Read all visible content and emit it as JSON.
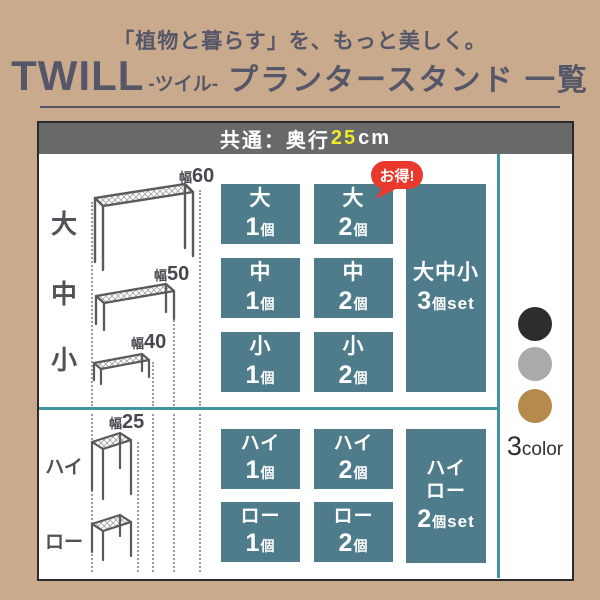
{
  "top_header": {
    "subtitle": "「植物と暮らす」を、もっと美しく。",
    "brand": "TWILL",
    "reading": "-ツイル-",
    "title": "プランタースタンド 一覧"
  },
  "panel_header": {
    "prefix": "共通：奥行",
    "depth_value": "25",
    "unit": "cm"
  },
  "badge": {
    "label": "お得!",
    "color": "#e9392d"
  },
  "row_labels": {
    "large": "大",
    "medium": "中",
    "small": "小",
    "high": "ハイ",
    "low": "ロー"
  },
  "width_labels": {
    "w60": {
      "prefix": "幅",
      "value": "60"
    },
    "w50": {
      "prefix": "幅",
      "value": "50"
    },
    "w40": {
      "prefix": "幅",
      "value": "40"
    },
    "w25": {
      "prefix": "幅",
      "value": "25"
    }
  },
  "products": {
    "large_1": {
      "name": "大",
      "qty": "1",
      "unit": "個"
    },
    "large_2": {
      "name": "大",
      "qty": "2",
      "unit": "個"
    },
    "medium_1": {
      "name": "中",
      "qty": "1",
      "unit": "個"
    },
    "medium_2": {
      "name": "中",
      "qty": "2",
      "unit": "個"
    },
    "small_1": {
      "name": "小",
      "qty": "1",
      "unit": "個"
    },
    "small_2": {
      "name": "小",
      "qty": "2",
      "unit": "個"
    },
    "set_3": {
      "names": "大中小",
      "qty": "3",
      "unit": "個",
      "suffix": "set"
    },
    "high_1": {
      "name": "ハイ",
      "qty": "1",
      "unit": "個"
    },
    "high_2": {
      "name": "ハイ",
      "qty": "2",
      "unit": "個"
    },
    "low_1": {
      "name": "ロー",
      "qty": "1",
      "unit": "個"
    },
    "low_2": {
      "name": "ロー",
      "qty": "2",
      "unit": "個"
    },
    "set_hl": {
      "name_high": "ハイ",
      "name_low": "ロー",
      "qty": "2",
      "unit": "個",
      "suffix": "set"
    }
  },
  "swatches": {
    "count": "3",
    "word": "color",
    "dots": [
      {
        "name": "black",
        "hex": "#2d2d2d"
      },
      {
        "name": "gray",
        "hex": "#aaaaaa"
      },
      {
        "name": "gold",
        "hex": "#b58a4b"
      }
    ]
  },
  "colors": {
    "background_tan": "#c9aa8c",
    "box_teal": "#4f7c8b",
    "line_teal": "#3f96a0",
    "header_bar_gray": "#67696b",
    "accent_yellow": "#efe92e",
    "badge_red": "#e9392d",
    "title_ink": "#555667"
  }
}
